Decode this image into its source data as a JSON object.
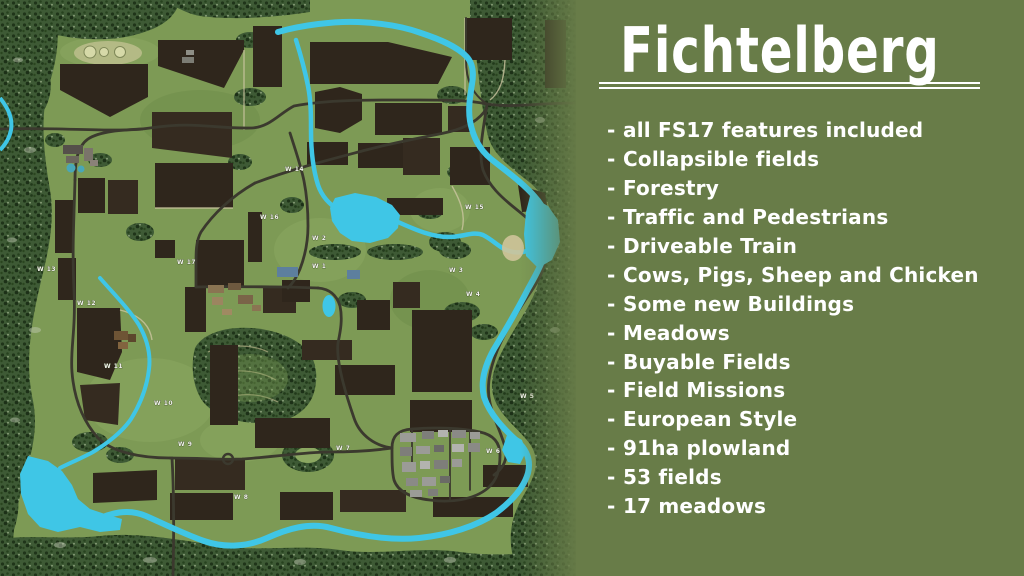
{
  "title": "Fichtelberg",
  "bullet": "-",
  "features": [
    "all FS17 features included",
    "Collapsible fields",
    "Forestry",
    "Traffic and Pedestrians",
    "Driveable Train",
    "Cows, Pigs, Sheep and Chicken",
    "Some new Buildings",
    "Meadows",
    "Buyable Fields",
    "Field Missions",
    "European Style",
    "91ha plowland",
    "53 fields",
    "17 meadows"
  ],
  "panel": {
    "background": "#687c48",
    "text_color": "#ffffff"
  },
  "map": {
    "colors": {
      "meadow_base": "#7d9a55",
      "forest": "#3e5a35",
      "field": "#2f261c",
      "water": "#3fc6e6",
      "road": "#3b392e",
      "label": "#f3f3ee"
    },
    "meadow_labels": [
      {
        "label": "W 1"
      },
      {
        "label": "W 2"
      },
      {
        "label": "W 3"
      },
      {
        "label": "W 4"
      },
      {
        "label": "W 5"
      },
      {
        "label": "W 6"
      },
      {
        "label": "W 7"
      },
      {
        "label": "W 8"
      },
      {
        "label": "W 9"
      },
      {
        "label": "W 10"
      },
      {
        "label": "W 11"
      },
      {
        "label": "W 12"
      },
      {
        "label": "W 13"
      },
      {
        "label": "W 14"
      },
      {
        "label": "W 15"
      },
      {
        "label": "W 16"
      },
      {
        "label": "W 17"
      }
    ]
  }
}
